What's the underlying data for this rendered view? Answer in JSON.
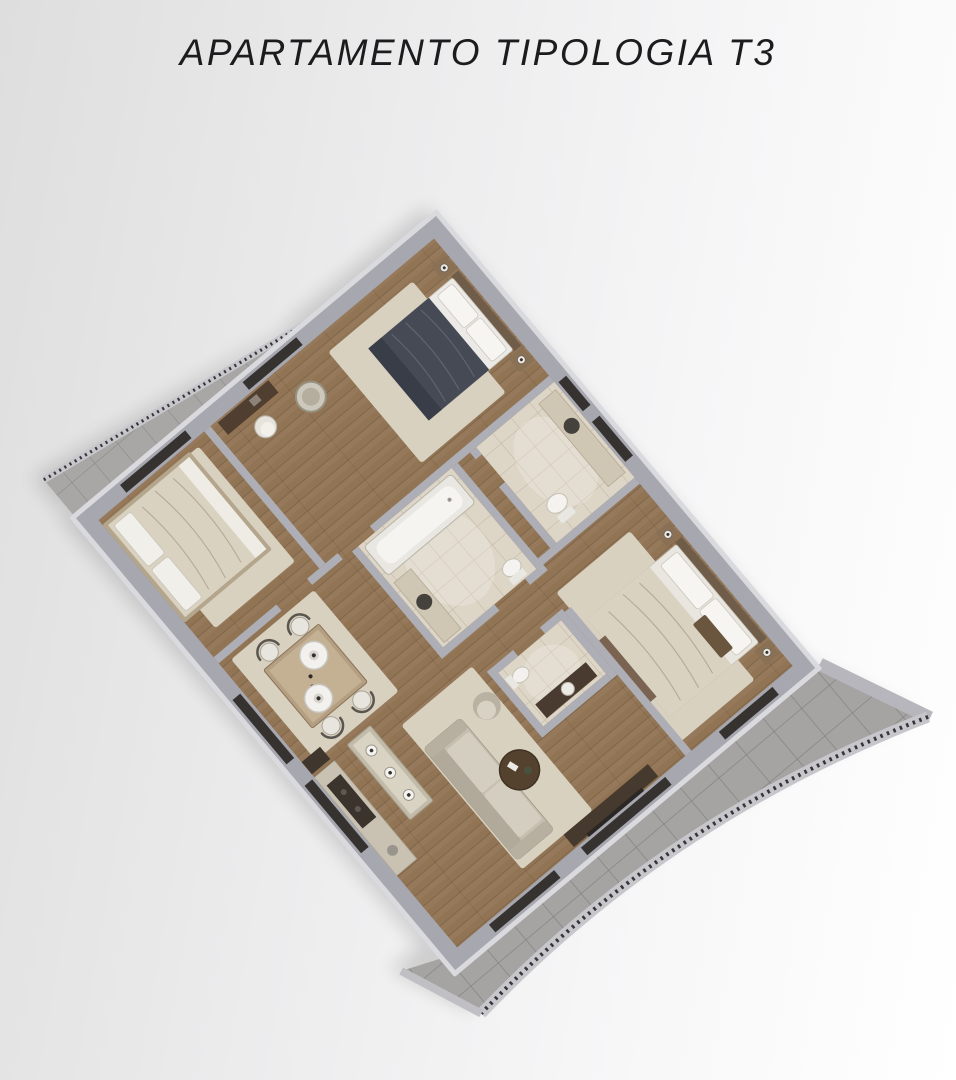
{
  "page": {
    "title": "APARTAMENTO TIPOLOGIA T3"
  },
  "colors": {
    "background_start": "#dedede",
    "background_end": "#ffffff",
    "title": "#1c1c1e",
    "wall": "#a7a7b0",
    "wall_highlight": "#dadade",
    "interior_wall": "#aeaeb6",
    "wood_floor": "#917454",
    "bathroom_tile": "#ddd5c6",
    "terrace_tile": "#a5a4a2",
    "balcony_tile": "#a8a7a5",
    "rug": "#d8d1c0",
    "bed_dark_cover": "#454a55",
    "bed_cream_cover": "#d9d2c1",
    "dark_furniture": "#503f31",
    "white_furniture": "#f0efec",
    "railing": "#35353a",
    "window_slit": "#35322f"
  },
  "plan": {
    "type": "apartment-3d-floor-plan",
    "typology": "T3",
    "rooms": [
      {
        "id": "bedroom-1",
        "furniture": [
          "double-bed-dark-cover",
          "nightstand",
          "nightstand",
          "table-lamp",
          "table-lamp",
          "rug",
          "desk",
          "desk-chair",
          "laundry-basket"
        ]
      },
      {
        "id": "bedroom-2",
        "furniture": [
          "double-bed-cream-cover",
          "rug"
        ]
      },
      {
        "id": "bedroom-3",
        "furniture": [
          "double-bed-cream-cover",
          "nightstand",
          "nightstand",
          "table-lamp",
          "table-lamp",
          "rug",
          "foot-bench"
        ]
      },
      {
        "id": "bathroom-1",
        "furniture": [
          "washbasin-counter",
          "toilet"
        ]
      },
      {
        "id": "bathroom-2",
        "furniture": [
          "bathtub",
          "washbasin-counter",
          "toilet"
        ]
      },
      {
        "id": "wc",
        "furniture": [
          "washbasin-counter",
          "toilet"
        ]
      },
      {
        "id": "hallway",
        "furniture": []
      },
      {
        "id": "dining-area",
        "furniture": [
          "dining-table",
          "chair",
          "chair",
          "chair",
          "chair",
          "pendant-lamp",
          "pendant-lamp"
        ]
      },
      {
        "id": "kitchen",
        "furniture": [
          "island",
          "pendant-light",
          "pendant-light",
          "pendant-light",
          "counter",
          "cooktop",
          "tall-cabinet"
        ]
      },
      {
        "id": "living-area",
        "furniture": [
          "sofa",
          "armchair",
          "round-coffee-table",
          "tv-sideboard",
          "rug"
        ]
      },
      {
        "id": "balcony",
        "furniture": [
          "tiled-floor",
          "railing"
        ]
      },
      {
        "id": "terrace",
        "furniture": [
          "tiled-floor",
          "curved-railing"
        ]
      }
    ]
  }
}
